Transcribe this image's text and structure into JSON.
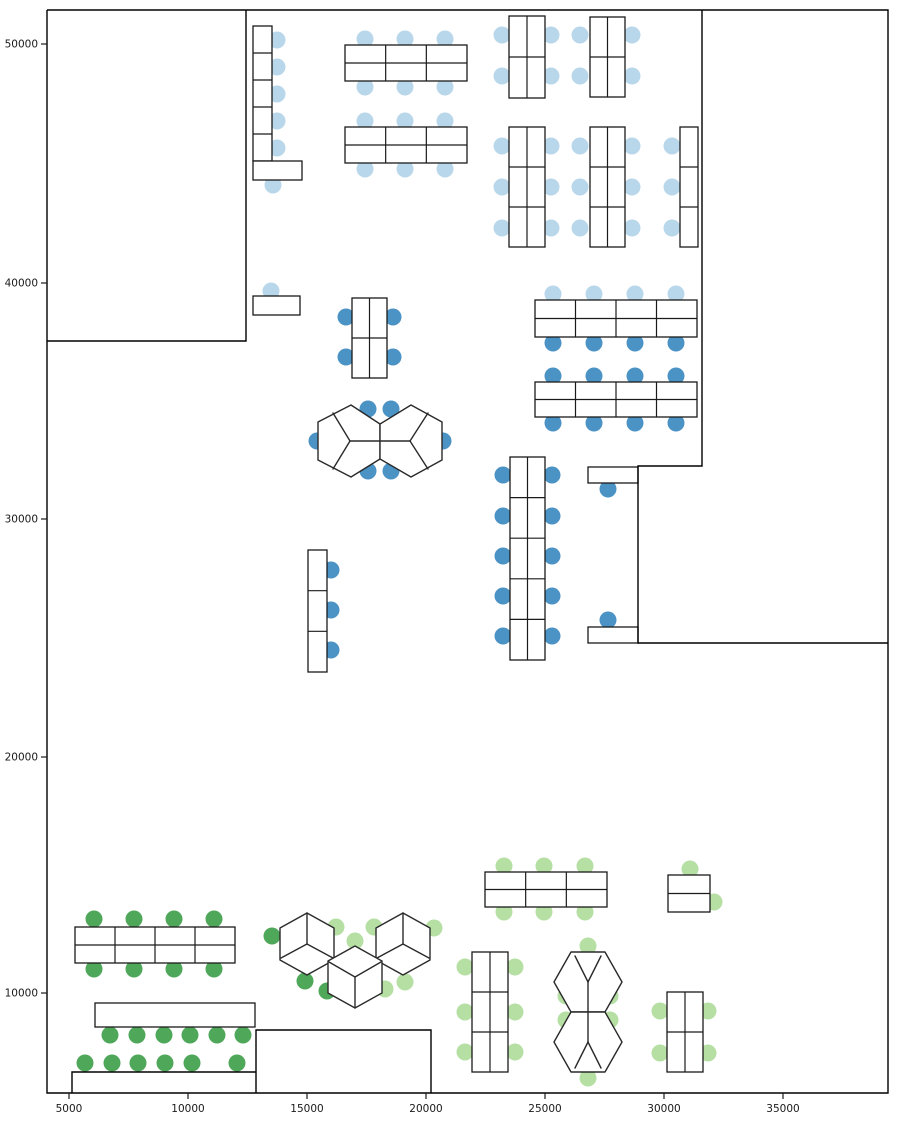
{
  "figure": {
    "width": 897,
    "height": 1122,
    "background": "#ffffff",
    "title": ""
  },
  "colors": {
    "seat_light_blue": "#b9d7ea",
    "seat_dark_blue": "#4b92c5",
    "seat_dark_green": "#4fa75a",
    "seat_light_green": "#b6dfa4",
    "wall_stroke": "#000000",
    "desk_stroke": "#1a1a1a",
    "pod_stroke": "#2a2a2a",
    "tick_text": "#1a1a1a"
  },
  "chart_data": {
    "type": "scatter",
    "subtype": "office-floorplan",
    "title": "",
    "xlabel": "",
    "ylabel": "",
    "x_ticks": [
      {
        "value": "5000",
        "px": 69
      },
      {
        "value": "10000",
        "px": 188
      },
      {
        "value": "15000",
        "px": 307
      },
      {
        "value": "20000",
        "px": 426
      },
      {
        "value": "25000",
        "px": 545
      },
      {
        "value": "30000",
        "px": 664
      },
      {
        "value": "35000",
        "px": 783
      }
    ],
    "y_ticks": [
      {
        "value": "50000",
        "px": 44
      },
      {
        "value": "40000",
        "px": 283
      },
      {
        "value": "30000",
        "px": 519
      },
      {
        "value": "20000",
        "px": 757
      },
      {
        "value": "10000",
        "px": 993
      }
    ],
    "axis_calibration": {
      "x_data_from_px": "x_data = 5000 + (x_px - 69) * 42.0",
      "y_data_from_px": "y_data = 50000 - (y_px - 44) * 42.1",
      "xlim_data": [
        4080,
        39400
      ],
      "ylim_data": [
        5800,
        51400
      ]
    },
    "walls_px": [
      [
        [
          47,
          10
        ],
        [
          888,
          10
        ],
        [
          888,
          1093
        ],
        [
          47,
          1093
        ],
        [
          47,
          10
        ]
      ],
      [
        [
          47,
          341
        ],
        [
          246,
          341
        ],
        [
          246,
          10
        ]
      ],
      [
        [
          702,
          10
        ],
        [
          702,
          466
        ],
        [
          638,
          466
        ],
        [
          638,
          643
        ],
        [
          888,
          643
        ]
      ],
      [
        [
          256,
          1093
        ],
        [
          256,
          1030
        ],
        [
          431,
          1030
        ],
        [
          431,
          1093
        ]
      ],
      [
        [
          72,
          1093
        ],
        [
          72,
          1072
        ],
        [
          256,
          1072
        ]
      ]
    ],
    "desk_blocks_px": [
      {
        "x": 253,
        "y": 26,
        "w": 19,
        "h": 135,
        "cols": 1,
        "rows": 5
      },
      {
        "x": 253,
        "y": 161,
        "w": 49,
        "h": 19,
        "cols": 1,
        "rows": 1
      },
      {
        "x": 345,
        "y": 45,
        "w": 122,
        "h": 36,
        "cols": 3,
        "rows": 2
      },
      {
        "x": 345,
        "y": 127,
        "w": 122,
        "h": 36,
        "cols": 3,
        "rows": 2
      },
      {
        "x": 509,
        "y": 16,
        "w": 36,
        "h": 82,
        "cols": 2,
        "rows": 2
      },
      {
        "x": 590,
        "y": 17,
        "w": 35,
        "h": 80,
        "cols": 2,
        "rows": 2
      },
      {
        "x": 509,
        "y": 127,
        "w": 36,
        "h": 120,
        "cols": 2,
        "rows": 3
      },
      {
        "x": 590,
        "y": 127,
        "w": 35,
        "h": 120,
        "cols": 2,
        "rows": 3
      },
      {
        "x": 680,
        "y": 127,
        "w": 18,
        "h": 120,
        "cols": 1,
        "rows": 3
      },
      {
        "x": 253,
        "y": 296,
        "w": 47,
        "h": 19,
        "cols": 1,
        "rows": 1
      },
      {
        "x": 352,
        "y": 298,
        "w": 35,
        "h": 80,
        "cols": 2,
        "rows": 2
      },
      {
        "x": 535,
        "y": 300,
        "w": 162,
        "h": 37,
        "cols": 4,
        "rows": 2
      },
      {
        "x": 535,
        "y": 382,
        "w": 162,
        "h": 35,
        "cols": 4,
        "rows": 2
      },
      {
        "x": 510,
        "y": 457,
        "w": 35,
        "h": 203,
        "cols": 2,
        "rows": 5
      },
      {
        "x": 308,
        "y": 550,
        "w": 19,
        "h": 122,
        "cols": 1,
        "rows": 3
      },
      {
        "x": 588,
        "y": 467,
        "w": 50,
        "h": 16,
        "cols": 1,
        "rows": 1
      },
      {
        "x": 588,
        "y": 627,
        "w": 50,
        "h": 16,
        "cols": 1,
        "rows": 1
      },
      {
        "x": 75,
        "y": 927,
        "w": 160,
        "h": 36,
        "cols": 4,
        "rows": 2
      },
      {
        "x": 95,
        "y": 1003,
        "w": 160,
        "h": 24,
        "cols": 1,
        "rows": 1
      },
      {
        "x": 485,
        "y": 872,
        "w": 122,
        "h": 35,
        "cols": 3,
        "rows": 2
      },
      {
        "x": 668,
        "y": 875,
        "w": 42,
        "h": 37,
        "cols": 1,
        "rows": 2
      },
      {
        "x": 472,
        "y": 952,
        "w": 36,
        "h": 120,
        "cols": 2,
        "rows": 3
      },
      {
        "x": 667,
        "y": 992,
        "w": 36,
        "h": 80,
        "cols": 2,
        "rows": 2
      }
    ],
    "hex_pods_px": [
      {
        "verts": [
          [
            351,
            405
          ],
          [
            380,
            424
          ],
          [
            380,
            459
          ],
          [
            351,
            477
          ],
          [
            318,
            460
          ],
          [
            318,
            422
          ]
        ],
        "center": [
          350,
          441
        ],
        "spokes": [
          [
            333,
            413
          ],
          [
            333,
            469
          ],
          [
            380,
            441
          ]
        ]
      },
      {
        "verts": [
          [
            411,
            405
          ],
          [
            442,
            422
          ],
          [
            442,
            460
          ],
          [
            411,
            477
          ],
          [
            380,
            459
          ],
          [
            380,
            424
          ]
        ],
        "center": [
          410,
          441
        ],
        "spokes": [
          [
            428,
            413
          ],
          [
            428,
            469
          ],
          [
            380,
            441
          ]
        ]
      },
      {
        "verts": [
          [
            307,
            913
          ],
          [
            334,
            928
          ],
          [
            334,
            960
          ],
          [
            307,
            975
          ],
          [
            280,
            960
          ],
          [
            280,
            928
          ]
        ],
        "center": [
          307,
          944
        ],
        "spokes": [
          [
            307,
            913
          ],
          [
            281,
            958
          ],
          [
            333,
            958
          ]
        ]
      },
      {
        "verts": [
          [
            403,
            913
          ],
          [
            430,
            928
          ],
          [
            430,
            960
          ],
          [
            403,
            975
          ],
          [
            376,
            960
          ],
          [
            376,
            928
          ]
        ],
        "center": [
          403,
          944
        ],
        "spokes": [
          [
            403,
            913
          ],
          [
            377,
            958
          ],
          [
            429,
            958
          ]
        ]
      },
      {
        "verts": [
          [
            355,
            946
          ],
          [
            382,
            961
          ],
          [
            382,
            993
          ],
          [
            355,
            1008
          ],
          [
            328,
            993
          ],
          [
            328,
            961
          ]
        ],
        "center": [
          355,
          977
        ],
        "spokes": [
          [
            355,
            1008
          ],
          [
            329,
            962
          ],
          [
            381,
            962
          ]
        ]
      },
      {
        "verts": [
          [
            571,
            952
          ],
          [
            605,
            952
          ],
          [
            622,
            982
          ],
          [
            605,
            1012
          ],
          [
            571,
            1012
          ],
          [
            554,
            982
          ]
        ],
        "center": [
          588,
          982
        ],
        "spokes": [
          [
            575,
            956
          ],
          [
            601,
            956
          ],
          [
            588,
            1012
          ]
        ]
      },
      {
        "verts": [
          [
            571,
            1012
          ],
          [
            605,
            1012
          ],
          [
            622,
            1042
          ],
          [
            605,
            1072
          ],
          [
            571,
            1072
          ],
          [
            554,
            1042
          ]
        ],
        "center": [
          588,
          1042
        ],
        "spokes": [
          [
            588,
            1012
          ],
          [
            575,
            1068
          ],
          [
            601,
            1068
          ]
        ]
      }
    ],
    "seat_radius_px": 8.5,
    "seat_groups": [
      {
        "name": "upper-zone-light-blue",
        "color_key": "seat_light_blue",
        "points": [
          [
            277,
            40
          ],
          [
            277,
            67
          ],
          [
            277,
            94
          ],
          [
            277,
            121
          ],
          [
            277,
            148
          ],
          [
            273,
            185
          ],
          [
            365,
            39
          ],
          [
            405,
            39
          ],
          [
            445,
            39
          ],
          [
            365,
            87
          ],
          [
            405,
            87
          ],
          [
            445,
            87
          ],
          [
            365,
            121
          ],
          [
            405,
            121
          ],
          [
            445,
            121
          ],
          [
            365,
            169
          ],
          [
            405,
            169
          ],
          [
            445,
            169
          ],
          [
            502,
            35
          ],
          [
            502,
            76
          ],
          [
            551,
            35
          ],
          [
            551,
            76
          ],
          [
            580,
            35
          ],
          [
            580,
            76
          ],
          [
            632,
            35
          ],
          [
            632,
            76
          ],
          [
            502,
            146
          ],
          [
            502,
            187
          ],
          [
            502,
            228
          ],
          [
            551,
            146
          ],
          [
            551,
            187
          ],
          [
            551,
            228
          ],
          [
            580,
            146
          ],
          [
            580,
            187
          ],
          [
            580,
            228
          ],
          [
            632,
            146
          ],
          [
            632,
            187
          ],
          [
            632,
            228
          ],
          [
            672,
            146
          ],
          [
            672,
            187
          ],
          [
            672,
            228
          ],
          [
            271,
            291
          ],
          [
            553,
            294
          ],
          [
            594,
            294
          ],
          [
            635,
            294
          ],
          [
            676,
            294
          ]
        ]
      },
      {
        "name": "middle-zone-dark-blue",
        "color_key": "seat_dark_blue",
        "points": [
          [
            346,
            317
          ],
          [
            346,
            357
          ],
          [
            393,
            317
          ],
          [
            393,
            357
          ],
          [
            553,
            343
          ],
          [
            594,
            343
          ],
          [
            635,
            343
          ],
          [
            676,
            343
          ],
          [
            553,
            376
          ],
          [
            594,
            376
          ],
          [
            635,
            376
          ],
          [
            676,
            376
          ],
          [
            553,
            423
          ],
          [
            594,
            423
          ],
          [
            635,
            423
          ],
          [
            676,
            423
          ],
          [
            368,
            409
          ],
          [
            391,
            409
          ],
          [
            317,
            441
          ],
          [
            443,
            441
          ],
          [
            368,
            471
          ],
          [
            391,
            471
          ],
          [
            608,
            489
          ],
          [
            608,
            620
          ],
          [
            503,
            475
          ],
          [
            503,
            516
          ],
          [
            503,
            556
          ],
          [
            503,
            596
          ],
          [
            503,
            636
          ],
          [
            552,
            475
          ],
          [
            552,
            516
          ],
          [
            552,
            556
          ],
          [
            552,
            596
          ],
          [
            552,
            636
          ],
          [
            331,
            570
          ],
          [
            331,
            610
          ],
          [
            331,
            650
          ]
        ]
      },
      {
        "name": "lower-left-dark-green",
        "color_key": "seat_dark_green",
        "points": [
          [
            94,
            919
          ],
          [
            134,
            919
          ],
          [
            174,
            919
          ],
          [
            214,
            919
          ],
          [
            94,
            969
          ],
          [
            134,
            969
          ],
          [
            174,
            969
          ],
          [
            214,
            969
          ],
          [
            110,
            1035
          ],
          [
            137,
            1035
          ],
          [
            164,
            1035
          ],
          [
            190,
            1035
          ],
          [
            217,
            1035
          ],
          [
            243,
            1035
          ],
          [
            85,
            1063
          ],
          [
            112,
            1063
          ],
          [
            138,
            1063
          ],
          [
            165,
            1063
          ],
          [
            192,
            1063
          ],
          [
            237,
            1063
          ],
          [
            272,
            936
          ],
          [
            305,
            981
          ],
          [
            327,
            991
          ]
        ]
      },
      {
        "name": "lower-right-light-green",
        "color_key": "seat_light_green",
        "points": [
          [
            336,
            927
          ],
          [
            355,
            941
          ],
          [
            374,
            927
          ],
          [
            434,
            928
          ],
          [
            385,
            989
          ],
          [
            405,
            982
          ],
          [
            504,
            866
          ],
          [
            544,
            866
          ],
          [
            585,
            866
          ],
          [
            504,
            912
          ],
          [
            544,
            912
          ],
          [
            585,
            912
          ],
          [
            690,
            869
          ],
          [
            714,
            902
          ],
          [
            465,
            967
          ],
          [
            465,
            1012
          ],
          [
            465,
            1052
          ],
          [
            515,
            967
          ],
          [
            515,
            1012
          ],
          [
            515,
            1052
          ],
          [
            588,
            946
          ],
          [
            566,
            996
          ],
          [
            566,
            1020
          ],
          [
            610,
            996
          ],
          [
            610,
            1020
          ],
          [
            588,
            1078
          ],
          [
            660,
            1011
          ],
          [
            660,
            1053
          ],
          [
            708,
            1011
          ],
          [
            708,
            1053
          ]
        ]
      }
    ],
    "axes_frame_px": {
      "left": 47,
      "top": 10,
      "right": 888,
      "bottom": 1093
    },
    "grid": false,
    "legend": null
  }
}
